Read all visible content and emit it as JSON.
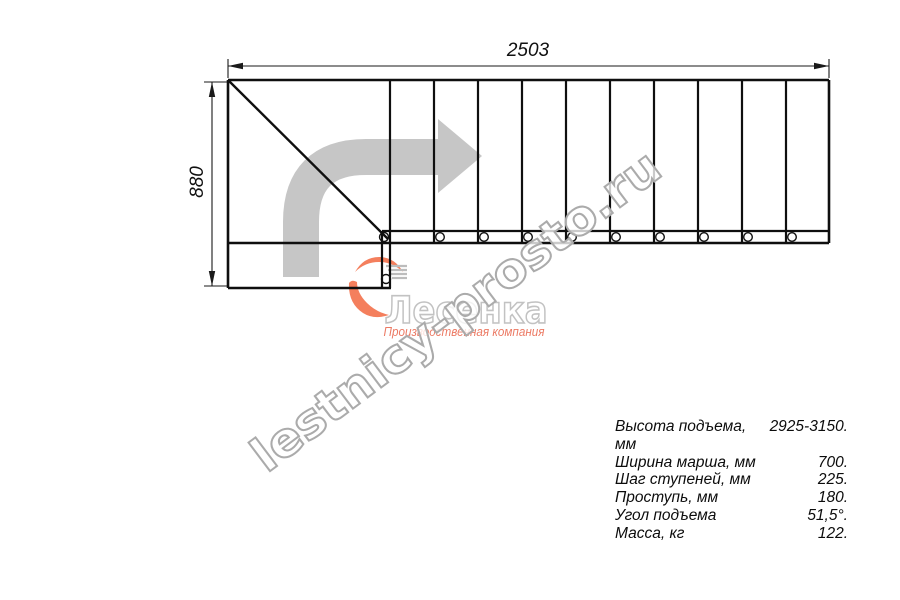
{
  "drawing": {
    "width_dim": "2503",
    "height_dim": "880"
  },
  "watermark": "lestnicy-prosto.ru",
  "logo": {
    "name": "Лесенка",
    "tagline": "Производственная компания",
    "accent_color": "#f15a2e"
  },
  "specs": {
    "rows": [
      {
        "label": "Высота подъема, мм",
        "value": "2925-3150."
      },
      {
        "label": "Ширина марша, мм",
        "value": "700."
      },
      {
        "label": "Шаг ступеней, мм",
        "value": "225."
      },
      {
        "label": "Проступь, мм",
        "value": "180."
      },
      {
        "label": "Угол подъема",
        "value": "51,5°."
      },
      {
        "label": "Масса, кг",
        "value": "122."
      }
    ]
  },
  "colors": {
    "line": "#0f0f0f",
    "direction_arrow": "#c6c6c6",
    "watermark_outline": "#ababab",
    "brand_red": "#f15a2e"
  }
}
